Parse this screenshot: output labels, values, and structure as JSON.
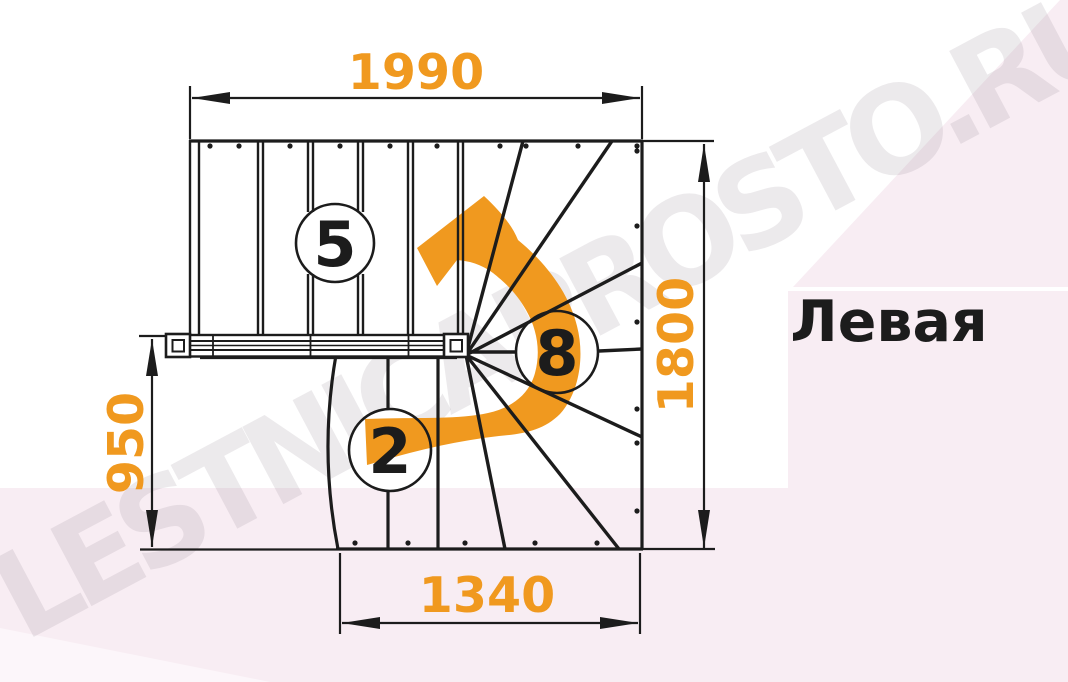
{
  "watermark": "LESTNICAPROSTO.RU",
  "orientation_label": "Левая",
  "dimensions": {
    "top_width_mm": "1990",
    "right_height_mm": "1800",
    "left_height_mm": "950",
    "bottom_width_mm": "1340"
  },
  "step_badges": {
    "upper_flight": "5",
    "winders": "8",
    "lower_flight": "2"
  },
  "colors": {
    "accent_orange": "#F0991F",
    "line_black": "#1C1C1C",
    "bg_pink": "#F8EDF3",
    "bg_pink_light": "#FCF6FA",
    "watermark_gray": "#8A7A86"
  }
}
